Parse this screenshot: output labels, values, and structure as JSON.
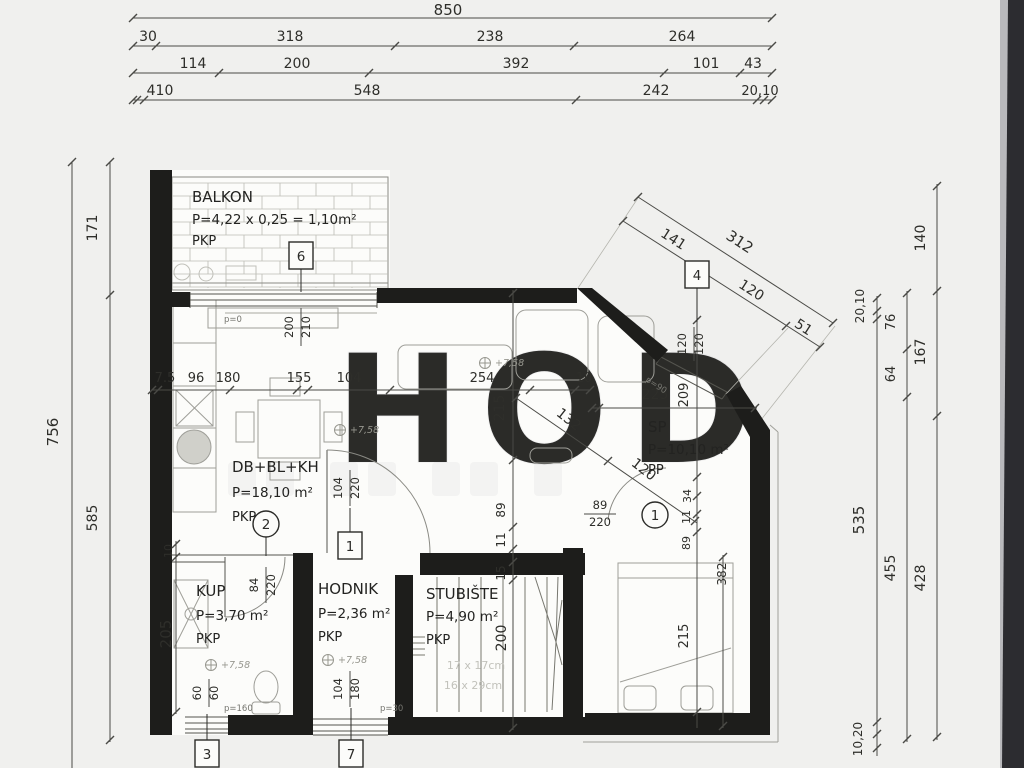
{
  "colors": {
    "paper": "#f0f0ee",
    "plan_white": "#fcfcfa",
    "ink": "#2b2b28",
    "wall_black": "#1d1d1b",
    "faint_gray": "#a3a39d",
    "scan_edge_dark": "#2c2c30"
  },
  "rooms": [
    {
      "name": "BALKON",
      "area": "P=4,22 x 0,25 = 1,10m²",
      "tag": "PKP"
    },
    {
      "name": "DB+BL+KH",
      "area": "P=18,10 m²",
      "tag": "PKP"
    },
    {
      "name": "KUP",
      "area": "P=3,70 m²",
      "tag": "PKP"
    },
    {
      "name": "HODNIK",
      "area": "P=2,36 m²",
      "tag": "PKP"
    },
    {
      "name": "STUBIŠTE",
      "area": "P=4,90 m²",
      "tag": "PKP"
    },
    {
      "name": "SP",
      "area": "P=10,10 m²",
      "tag": "PP"
    }
  ],
  "markers": {
    "boxes": [
      {
        "label": "6"
      },
      {
        "label": "4"
      },
      {
        "label": "1"
      },
      {
        "label": "3"
      },
      {
        "label": "7"
      }
    ],
    "circles": [
      {
        "label": "2"
      },
      {
        "label": "1"
      }
    ]
  },
  "dim_labels": [
    {
      "v": "850",
      "x": 448,
      "y": 15,
      "r": 0,
      "s": 15
    },
    {
      "v": "30",
      "x": 148,
      "y": 41,
      "r": 0,
      "s": 14
    },
    {
      "v": "318",
      "x": 290,
      "y": 41,
      "r": 0,
      "s": 14
    },
    {
      "v": "238",
      "x": 490,
      "y": 41,
      "r": 0,
      "s": 14
    },
    {
      "v": "264",
      "x": 682,
      "y": 41,
      "r": 0,
      "s": 14
    },
    {
      "v": "114",
      "x": 193,
      "y": 68,
      "r": 0,
      "s": 14
    },
    {
      "v": "200",
      "x": 297,
      "y": 68,
      "r": 0,
      "s": 14
    },
    {
      "v": "392",
      "x": 516,
      "y": 68,
      "r": 0,
      "s": 14
    },
    {
      "v": "101",
      "x": 706,
      "y": 68,
      "r": 0,
      "s": 14
    },
    {
      "v": "43",
      "x": 753,
      "y": 68,
      "r": 0,
      "s": 14
    },
    {
      "v": "410",
      "x": 160,
      "y": 95,
      "r": 0,
      "s": 14
    },
    {
      "v": "548",
      "x": 367,
      "y": 95,
      "r": 0,
      "s": 14
    },
    {
      "v": "242",
      "x": 656,
      "y": 95,
      "r": 0,
      "s": 14
    },
    {
      "v": "20,10",
      "x": 760,
      "y": 95,
      "r": 0,
      "s": 13
    },
    {
      "v": "756",
      "x": 58,
      "y": 432,
      "r": -90,
      "s": 15
    },
    {
      "v": "171",
      "x": 97,
      "y": 228,
      "r": -90,
      "s": 14
    },
    {
      "v": "585",
      "x": 97,
      "y": 518,
      "r": -90,
      "s": 14
    },
    {
      "v": "20,10",
      "x": 864,
      "y": 306,
      "r": -90,
      "s": 12
    },
    {
      "v": "535",
      "x": 864,
      "y": 520,
      "r": -90,
      "s": 15
    },
    {
      "v": "10,20",
      "x": 862,
      "y": 739,
      "r": -90,
      "s": 12
    },
    {
      "v": "76",
      "x": 895,
      "y": 322,
      "r": -90,
      "s": 13
    },
    {
      "v": "64",
      "x": 895,
      "y": 374,
      "r": -90,
      "s": 13
    },
    {
      "v": "455",
      "x": 895,
      "y": 568,
      "r": -90,
      "s": 14
    },
    {
      "v": "140",
      "x": 925,
      "y": 238,
      "r": -90,
      "s": 14
    },
    {
      "v": "167",
      "x": 925,
      "y": 352,
      "r": -90,
      "s": 14
    },
    {
      "v": "428",
      "x": 925,
      "y": 578,
      "r": -90,
      "s": 14
    },
    {
      "v": "312",
      "x": 737,
      "y": 246,
      "r": 33,
      "s": 15
    },
    {
      "v": "141",
      "x": 671,
      "y": 243,
      "r": 33,
      "s": 14
    },
    {
      "v": "120",
      "x": 749,
      "y": 294,
      "r": 33,
      "s": 14
    },
    {
      "v": "51",
      "x": 801,
      "y": 331,
      "r": 33,
      "s": 14
    },
    {
      "v": "209",
      "x": 688,
      "y": 395,
      "r": -90,
      "s": 13
    },
    {
      "v": "34",
      "x": 691,
      "y": 496,
      "r": -90,
      "s": 11
    },
    {
      "v": "11",
      "x": 690,
      "y": 517,
      "r": -90,
      "s": 11
    },
    {
      "v": "89",
      "x": 690,
      "y": 543,
      "r": -90,
      "s": 11
    },
    {
      "v": "215",
      "x": 688,
      "y": 636,
      "r": -90,
      "s": 13
    },
    {
      "v": "382",
      "x": 726,
      "y": 574,
      "r": -90,
      "s": 12
    },
    {
      "v": "225",
      "x": 655,
      "y": 399,
      "r": 0,
      "s": 14
    },
    {
      "v": "132",
      "x": 566,
      "y": 423,
      "r": 38,
      "s": 14
    },
    {
      "v": "120",
      "x": 641,
      "y": 473,
      "r": 38,
      "s": 14
    },
    {
      "v": "7.5",
      "x": 165,
      "y": 382,
      "r": 0,
      "s": 13
    },
    {
      "v": "96",
      "x": 196,
      "y": 382,
      "r": 0,
      "s": 13
    },
    {
      "v": "180",
      "x": 228,
      "y": 382,
      "r": 0,
      "s": 13
    },
    {
      "v": "155",
      "x": 299,
      "y": 382,
      "r": 0,
      "s": 13
    },
    {
      "v": "104",
      "x": 349,
      "y": 382,
      "r": 0,
      "s": 13
    },
    {
      "v": "254",
      "x": 482,
      "y": 382,
      "r": 0,
      "s": 13
    },
    {
      "v": "10",
      "x": 584,
      "y": 382,
      "r": 0,
      "s": 13
    },
    {
      "v": "215",
      "x": 504,
      "y": 408,
      "r": -90,
      "s": 14
    },
    {
      "v": "89",
      "x": 505,
      "y": 510,
      "r": -90,
      "s": 12
    },
    {
      "v": "11",
      "x": 505,
      "y": 540,
      "r": -90,
      "s": 12
    },
    {
      "v": "15",
      "x": 505,
      "y": 573,
      "r": -90,
      "s": 12
    },
    {
      "v": "200",
      "x": 506,
      "y": 638,
      "r": -90,
      "s": 14
    },
    {
      "v": "10",
      "x": 172,
      "y": 551,
      "r": -90,
      "s": 11
    },
    {
      "v": "205",
      "x": 171,
      "y": 634,
      "r": -90,
      "s": 15
    }
  ],
  "door_labels": [
    {
      "a": "200",
      "b": "210",
      "x": 301,
      "y": 327,
      "rot": -90,
      "len": 38
    },
    {
      "a": "104",
      "b": "220",
      "x": 350,
      "y": 488,
      "rot": -90,
      "len": 36
    },
    {
      "a": "84",
      "b": "220",
      "x": 266,
      "y": 585,
      "rot": -90,
      "len": 36
    },
    {
      "a": "60",
      "b": "60",
      "x": 209,
      "y": 693,
      "rot": -90,
      "len": 28
    },
    {
      "a": "104",
      "b": "180",
      "x": 350,
      "y": 689,
      "rot": -90,
      "len": 36
    },
    {
      "a": "120",
      "b": "120",
      "x": 694,
      "y": 344,
      "rot": -90,
      "len": 34
    },
    {
      "a": "89",
      "b": "220",
      "x": 600,
      "y": 514,
      "rot": 0,
      "len": 32
    }
  ],
  "annotations": {
    "p0": "p=0",
    "p90": "p=90",
    "p160": "p=160",
    "p30": "p=30",
    "level": "+7,58",
    "stair_note1": "17 x 17cm",
    "stair_note2": "16 x 29cm"
  },
  "watermark": {
    "text": "HOD"
  }
}
